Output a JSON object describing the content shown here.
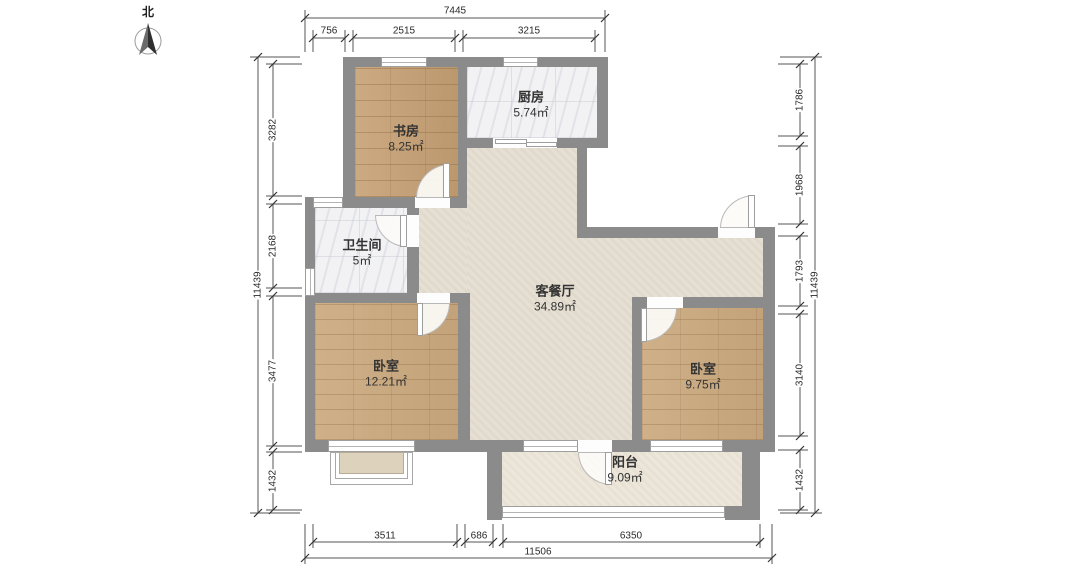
{
  "compass": {
    "label": "北"
  },
  "rooms": {
    "study": {
      "name": "书房",
      "area": "8.25㎡"
    },
    "kitchen": {
      "name": "厨房",
      "area": "5.74㎡"
    },
    "bathroom": {
      "name": "卫生间",
      "area": "5㎡"
    },
    "living": {
      "name": "客餐厅",
      "area": "34.89㎡"
    },
    "bedroom_left": {
      "name": "卧室",
      "area": "12.21㎡"
    },
    "bedroom_right": {
      "name": "卧室",
      "area": "9.75㎡"
    },
    "balcony": {
      "name": "阳台",
      "area": "9.09㎡"
    }
  },
  "dimensions": {
    "top": {
      "overall": "7445",
      "segments": [
        "756",
        "2515",
        "3215"
      ]
    },
    "bottom": {
      "overall": "11506",
      "segments": [
        "3511",
        "686",
        "6350"
      ]
    },
    "left": {
      "overall": "11439",
      "segments": [
        "3282",
        "2168",
        "3477",
        "1432"
      ]
    },
    "right": {
      "overall": "11439",
      "segments": [
        "1786",
        "1968",
        "1793",
        "3140",
        "1432"
      ]
    }
  },
  "colors": {
    "wall": "#8b8b8b",
    "wood_floor": "#c6a074",
    "tile_floor": "#f2f2f4",
    "living_floor": "#e5ded1",
    "balcony_floor": "#ece5d8",
    "dimension_line": "#555555"
  }
}
